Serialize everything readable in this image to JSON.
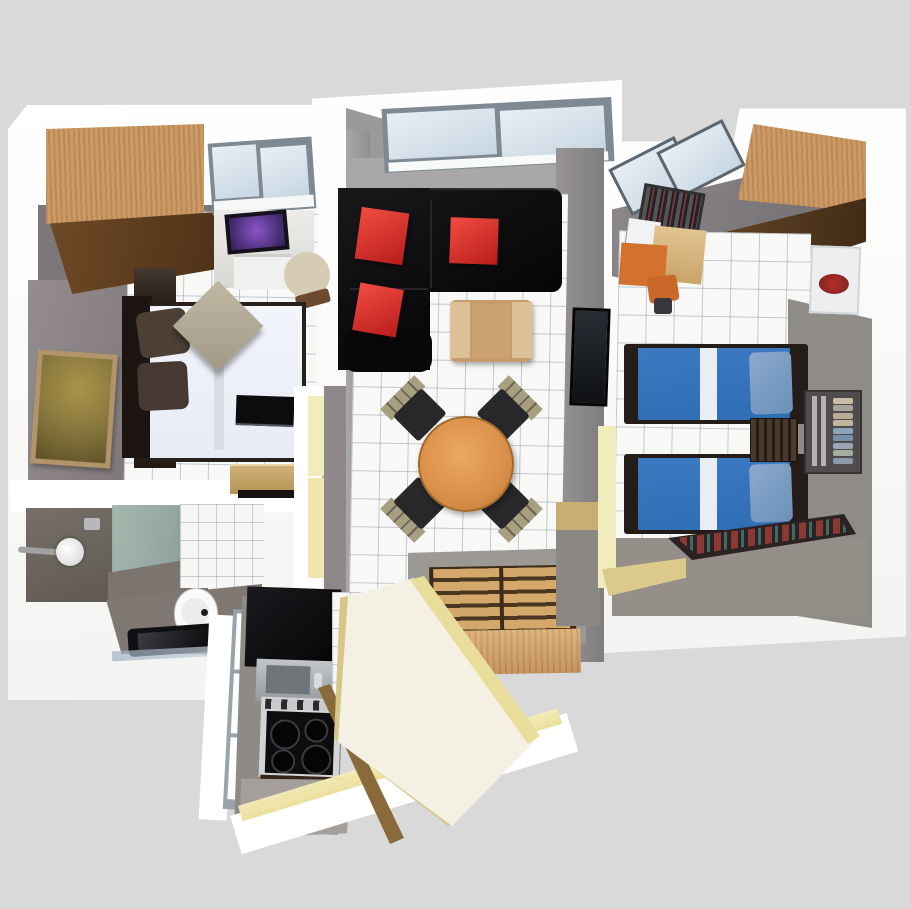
{
  "scene": {
    "description": "3D rendered top-down floor plan of a two-bedroom apartment with living room, kitchen corridor, bathroom and balcony",
    "background": "#d8d9d8"
  },
  "colors": {
    "bg": "#d8d9d8",
    "wall_white": "#ffffff",
    "wall_gray": "#8f898b",
    "wall_gray_dark": "#746e70",
    "wood_light": "#c9945e",
    "wood_shelf_dark": "#5a3c1e",
    "sofa_black": "#0c0c0e",
    "cushion_red": "#e23127",
    "armchair_tan": "#c59c6a",
    "table_wood": "#d98f48",
    "chair_back_khaki": "#a89e80",
    "chair_seat_black": "#28282a",
    "bed_duvet": "#f2f5fa",
    "headboard_dark": "#1d1511",
    "pillow_brown": "#4c3f35",
    "cushion_khaki": "#b3ac97",
    "bed_blue": "#2e6cb4",
    "bed_pillow_blue": "#7fa0c8",
    "glass_frame": "#7e8994",
    "bath_glass_green": "#9eb2ab",
    "shower_gray": "#6e6661",
    "balcony_cream": "#f4f1e4",
    "door_pale_yellow": "#f1ecbc",
    "edge_yellow": "#e9dd9b",
    "rug_base": "#2b2223",
    "rug_red": "#8a3a32",
    "rug_teal": "#3f6b64",
    "orange_chair": "#d2722e",
    "stove_steel": "#d2d4d6",
    "counter_black": "#101012",
    "cabinet_brown": "#40291a",
    "kitchen_gray_floor": "#8e8a85",
    "laptop_purple": "#8a56c8",
    "painting_gold": "#8d7b40",
    "poster_red": "#b23028"
  },
  "rooms": {
    "left_bedroom": {
      "furniture": [
        "wardrobe",
        "study-desk",
        "laptop",
        "printer",
        "desk-chair",
        "double-bed",
        "nightstand-top",
        "nightstand-bottom",
        "khaki-cushion",
        "wall-painting",
        "wall-tv",
        "vanity-counter",
        "window"
      ]
    },
    "bathroom": {
      "furniture": [
        "shower",
        "shower-head",
        "glass-panel",
        "toilet",
        "floor-tray"
      ]
    },
    "living_room": {
      "furniture": [
        "l-shaped-sofa",
        "red-cushion",
        "red-cushion",
        "red-cushion",
        "armchair",
        "dining-table",
        "dining-chair",
        "dining-chair",
        "dining-chair",
        "dining-chair",
        "slatted-sideboard",
        "wall-picture",
        "window"
      ]
    },
    "kitchen": {
      "furniture": [
        "black-countertop",
        "steel-sink",
        "stove-4-burners",
        "cabinet",
        "balcony-windows"
      ]
    },
    "balcony": {
      "furniture": [
        "cream-floor",
        "yellow-edges"
      ]
    },
    "right_bedroom": {
      "furniture": [
        "wardrobe",
        "single-bed-blue",
        "single-bed-blue",
        "dresser",
        "cd-wall-rack",
        "book-shelf",
        "desk",
        "orange-chair",
        "car-poster",
        "patterned-rug",
        "skylight-windows"
      ],
      "cd_rack_disc_colors": [
        "#c8bda2",
        "#a8a298",
        "#b8ac96",
        "#c2b49c",
        "#8aa4ba",
        "#7690a8",
        "#98a6b6",
        "#a4ae9e",
        "#8a9aa8"
      ]
    }
  }
}
